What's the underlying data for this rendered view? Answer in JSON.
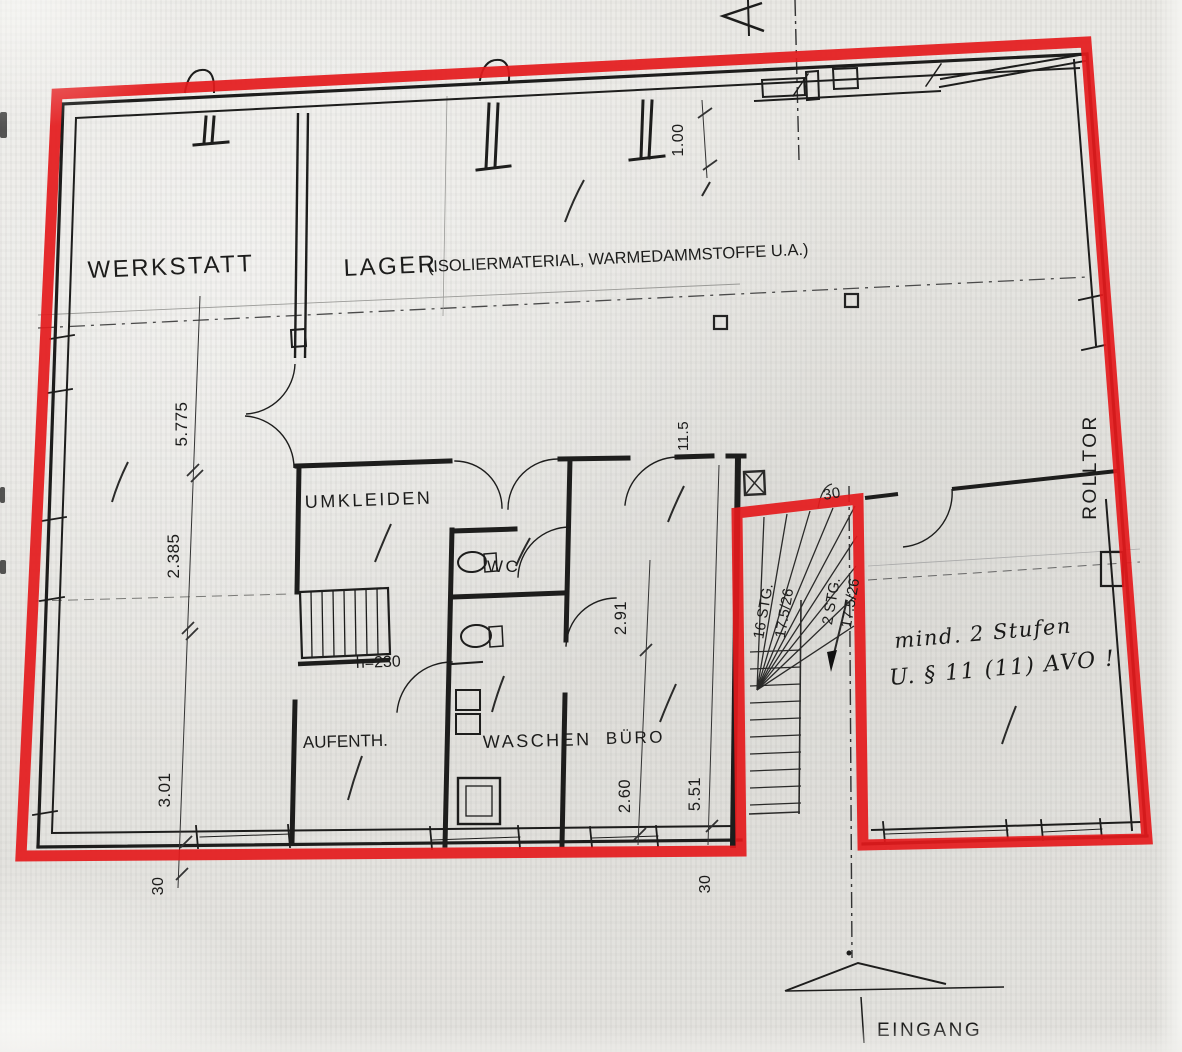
{
  "meta": {
    "ink_color": "#1d1d1c",
    "highlight_color": "#e41a1c",
    "paper_color": "#e8e7e3"
  },
  "rooms": {
    "werkstatt": "WERKSTATT",
    "lager": "LAGER",
    "lager_detail": "(ISOLIERMATERIAL, WARMEDAMMSTOFFE U.A.)",
    "umkleiden": "UMKLEIDEN",
    "wc": "WC",
    "aufenthalt": "AUFENTH.",
    "waschen": "WASCHEN",
    "buero": "BÜRO",
    "rolltor": "ROLLTOR",
    "eingang": "EINGANG"
  },
  "dims": {
    "d5775": "5.775",
    "d2385": "2.385",
    "d301": "3.01",
    "d30_left": "30",
    "d100": "1.00",
    "d115": "11.5",
    "d291": "2.91",
    "d260": "2.60",
    "d551": "5.51",
    "d30_bottom": "30",
    "d30_stair": "30"
  },
  "stairs": {
    "flight_main_steps": "16 STG.",
    "flight_main_size": "17.5/26",
    "flight_low_steps": "2 STG.",
    "flight_low_size": "17.5/26",
    "clear_height": "h=230"
  },
  "annotations": {
    "handwritten_1": "mind. 2 Stufen",
    "handwritten_2": "U. § 11 (11) AVO !"
  }
}
